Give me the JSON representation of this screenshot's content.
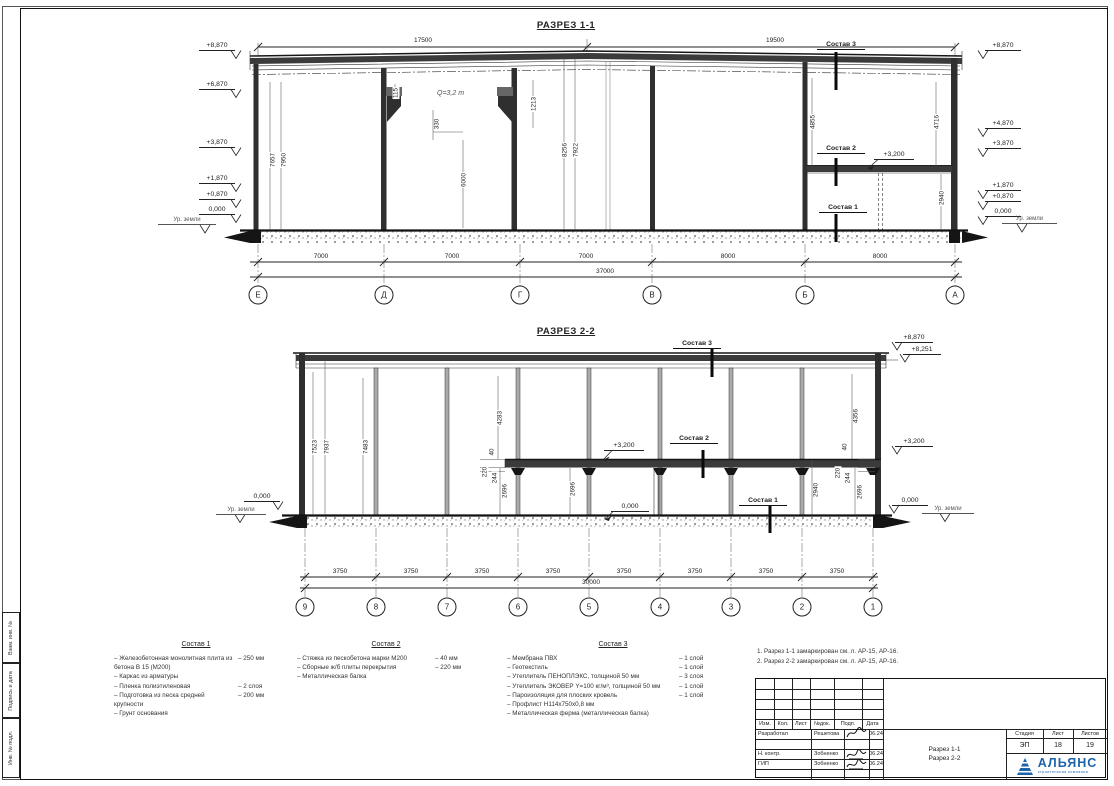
{
  "s1": {
    "title": "РАЗРЕЗ 1-1",
    "dim_left": "17500",
    "dim_right": "19500",
    "total": "37000",
    "spans": [
      "7000",
      "7000",
      "7000",
      "8000",
      "8000"
    ],
    "axes": [
      "Е",
      "Д",
      "Г",
      "В",
      "Б",
      "А"
    ],
    "marks_left": [
      "+8,870",
      "+6,870",
      "+3,870",
      "+1,870",
      "+0,870",
      "0,000"
    ],
    "marks_right": [
      "+8,870",
      "+4,870",
      "+3,870",
      "+1,870",
      "+0,870",
      "0,000"
    ],
    "ground_left": "Ур. земли",
    "ground_right": "Ур. земли",
    "crane": "Q=3,2 т",
    "lvl32": "+3,200",
    "sostav1": "Состав 1",
    "sostav2": "Состав 2",
    "sostav3": "Состав 3",
    "vdims": [
      "7657",
      "7950",
      "115",
      "330",
      "6000",
      "1213",
      "8256",
      "7922",
      "4855",
      "4716",
      "2940"
    ]
  },
  "s2": {
    "title": "РАЗРЕЗ 2-2",
    "total": "30000",
    "spans": [
      "3750",
      "3750",
      "3750",
      "3750",
      "3750",
      "3750",
      "3750",
      "3750"
    ],
    "axes": [
      "9",
      "8",
      "7",
      "6",
      "5",
      "4",
      "3",
      "2",
      "1"
    ],
    "mark_8870": "+8,870",
    "mark_8251": "+8,251",
    "lvl32_right": "+3,200",
    "lvl32_mid": "+3,200",
    "zero_mid": "0,000",
    "zero_left": "0,000",
    "zero_right": "0,000",
    "ground_left": "Ур. земли",
    "ground_right": "Ур. земли",
    "sostav1": "Состав 1",
    "sostav2": "Состав 2",
    "sostav3": "Состав 3",
    "vdims": [
      "7523",
      "7937",
      "7483",
      "4283",
      "40",
      "220",
      "244",
      "2696",
      "2696",
      "4356",
      "40",
      "220",
      "244",
      "2940",
      "2696"
    ]
  },
  "lg": [
    {
      "title": "Состав 1",
      "items": [
        {
          "t": "– Железобетонная монолитная плита из бетона В 15 (М200)",
          "v": "– 250 мм"
        },
        {
          "t": "– Каркас из арматуры",
          "v": ""
        },
        {
          "t": "– Пленка полиэтиленовая",
          "v": "– 2 слоя"
        },
        {
          "t": "– Подготовка из песка средней крупности",
          "v": "– 200 мм"
        },
        {
          "t": "– Грунт основания",
          "v": ""
        }
      ]
    },
    {
      "title": "Состав 2",
      "items": [
        {
          "t": "– Стяжка из пескобетона марки М200",
          "v": "– 40 мм"
        },
        {
          "t": "– Сборные ж/б плиты перекрытия",
          "v": "– 220 мм"
        },
        {
          "t": "– Металлическая балка",
          "v": ""
        }
      ]
    },
    {
      "title": "Состав 3",
      "items": [
        {
          "t": "– Мембрана ПВХ",
          "v": "– 1 слой"
        },
        {
          "t": "– Геотекстиль",
          "v": "– 1 слой"
        },
        {
          "t": "– Утеплитель ПЕНОПЛЭКС, толщиной 50 мм",
          "v": "– 3 слоя"
        },
        {
          "t": "– Утеплитель ЭКОВЕР Y=100 кг/м³, толщиной 50 мм",
          "v": "– 1 слой"
        },
        {
          "t": "– Пароизоляция для плоских кровель",
          "v": "– 1 слой"
        },
        {
          "t": "– Профлист Н114х750х0,8 мм",
          "v": ""
        },
        {
          "t": "– Металлическая ферма (металлическая балка)",
          "v": ""
        }
      ]
    }
  ],
  "notes": [
    "1. Разрез 1-1 замаркирован см. л. АР-15, АР-16.",
    "2. Разрез 2-2 замаркирован см. л. АР-15, АР-16."
  ],
  "tb": {
    "cols": [
      "Изм.",
      "Кол.",
      "Лист",
      "№док.",
      "Подп.",
      "Дата"
    ],
    "rows": [
      {
        "role": "Разработал",
        "name": "Решетова",
        "date": "06.24"
      },
      {
        "role": "Н. контр.",
        "name": "Зобненко",
        "date": "06.24"
      },
      {
        "role": "ГИП",
        "name": "Зобненко",
        "date": "06.24"
      }
    ],
    "stage_label": "Стадия",
    "sheet_label": "Лист",
    "sheets_label": "Листов",
    "stage": "ЭП",
    "sheet": "18",
    "sheets": "19",
    "title1": "Разрез 1-1",
    "title2": "Разрез 2-2",
    "logo": "АЛЬЯНС",
    "logo_sub": "строительная компания"
  },
  "strip": [
    "Взам. инв. №",
    "Подпись и дата",
    "Инв. № подл."
  ]
}
